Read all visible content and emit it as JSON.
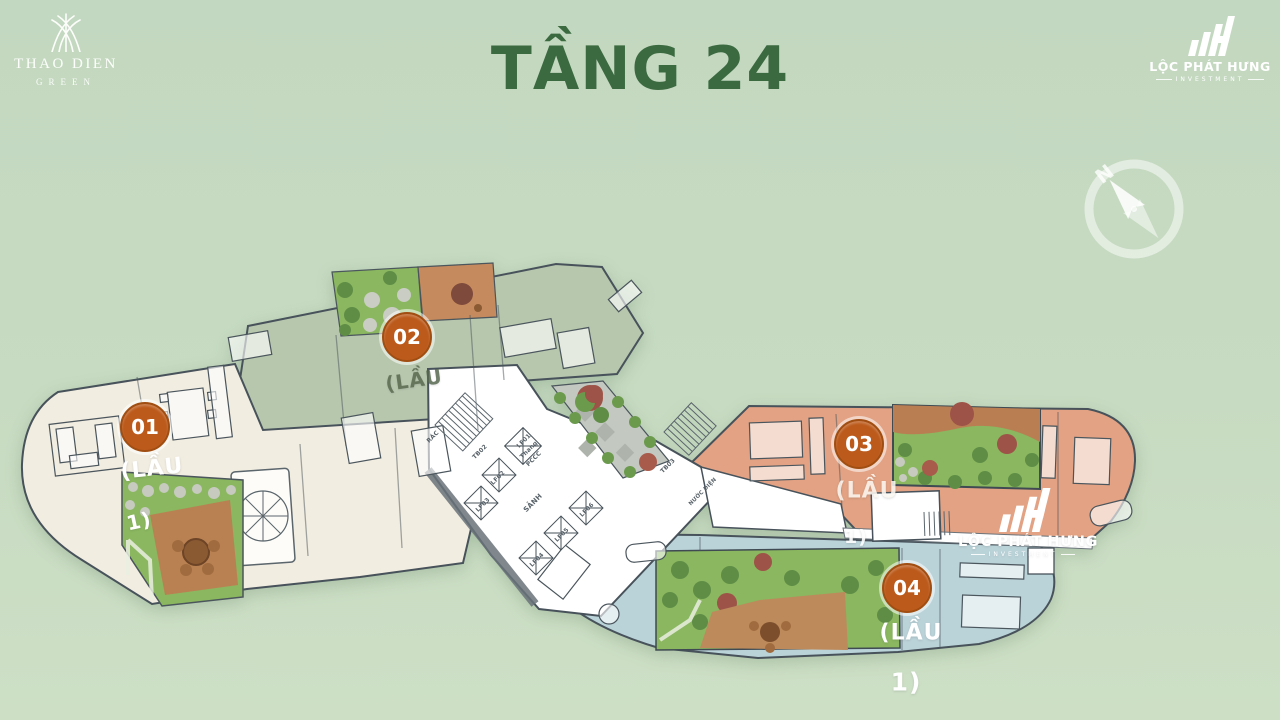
{
  "title": "TẦNG 24",
  "brand": {
    "name": "THAO DIEN",
    "sub": "GREEN"
  },
  "logo": {
    "name": "LỘC PHÁT HƯNG",
    "sub": "INVESTMENT"
  },
  "watermark": {
    "name": "LỘC PHÁT HƯNG",
    "sub": "INVESTMENT"
  },
  "compass": {
    "north": "N"
  },
  "units": [
    {
      "badge": "01",
      "label": "(LẦU",
      "label2": "1)"
    },
    {
      "badge": "02",
      "label": "(LẦU",
      "label2": ""
    },
    {
      "badge": "03",
      "label": "(LẦU",
      "label2": "1)"
    },
    {
      "badge": "04",
      "label": "(LẦU",
      "label2": "1)"
    }
  ],
  "core": {
    "labels": [
      {
        "text": "RÁC"
      },
      {
        "text": "TB02"
      },
      {
        "text": "LF01"
      },
      {
        "text": "Thang"
      },
      {
        "text": "PCCC"
      },
      {
        "text": "LF02"
      },
      {
        "text": "LF03"
      },
      {
        "text": "SẢNH"
      },
      {
        "text": "LF06"
      },
      {
        "text": "LF05"
      },
      {
        "text": "LF04"
      },
      {
        "text": "TB03"
      },
      {
        "text": "NƯỚC ĐIỆN"
      }
    ]
  },
  "colors": {
    "background": "#c6dbc3",
    "title_green": "#3c6a40",
    "badge_orange": "#bc5a1b",
    "unit01_fill": "#f2ede1",
    "unit02_fill": "#b7c7ae",
    "unit03_fill": "#e2a283",
    "unit04_fill": "#bad3d9",
    "garden_green": "#8ab75f",
    "terrace_brown": "#bd8a5c",
    "wall_dark": "#47525a",
    "logo_white": "#ffffff"
  }
}
